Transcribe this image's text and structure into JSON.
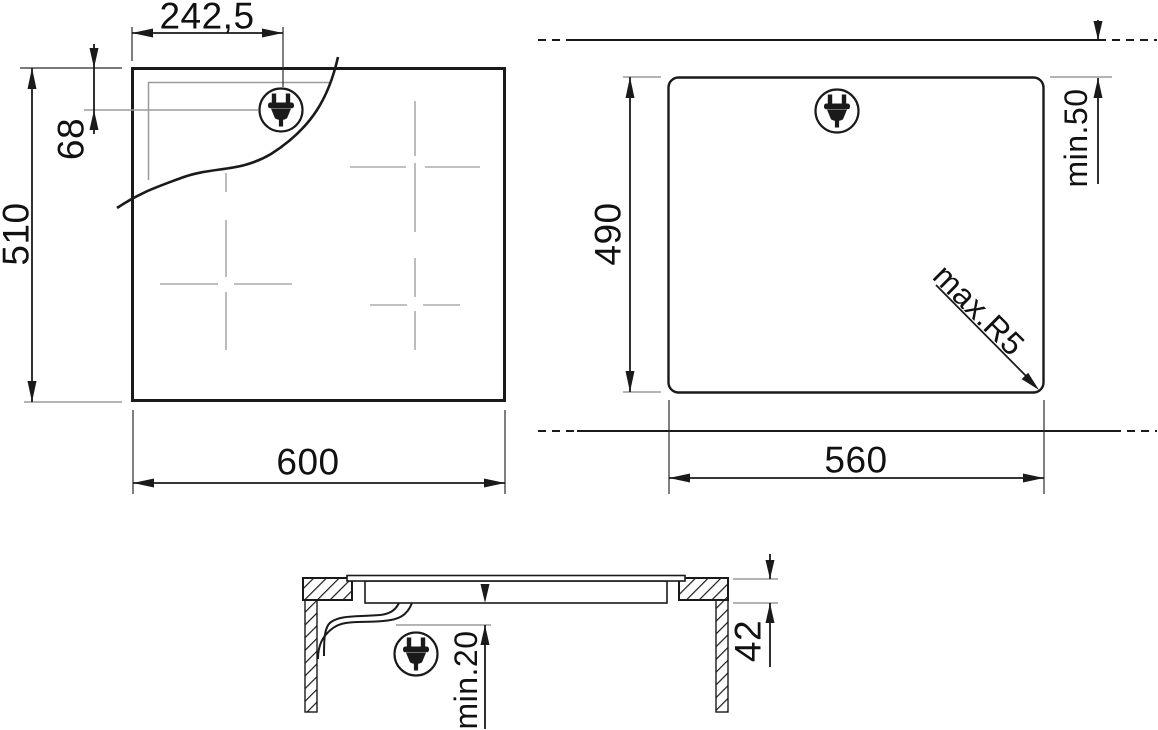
{
  "drawing": {
    "title": "hob-installation-diagram",
    "views": {
      "top": {
        "name": "hob-top-view",
        "dims": {
          "plug_offset_x": "242,5",
          "plug_offset_y": "68",
          "depth": "510",
          "width": "600"
        }
      },
      "cutout": {
        "name": "worktop-cutout-view",
        "dims": {
          "depth": "490",
          "width": "560",
          "rear_clearance": "min.50",
          "corner_radius": "max.R5"
        }
      },
      "section": {
        "name": "side-section-view",
        "dims": {
          "recess_depth": "42",
          "under_clearance": "min.20"
        }
      }
    },
    "colors": {
      "line": "#1a1a1a",
      "aux": "#9b9b9b",
      "cross": "#ababab",
      "background": "#ffffff"
    }
  }
}
